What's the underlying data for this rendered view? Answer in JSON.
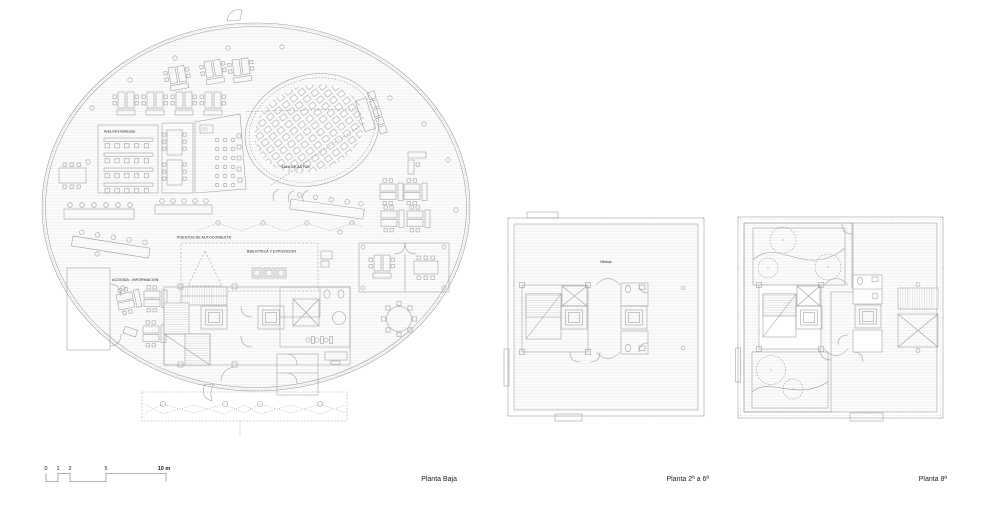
{
  "colors": {
    "line": "#9a9a9a",
    "wall": "#6e6e6e",
    "dark": "#454545",
    "text": "#222222",
    "green": "#e6ecd6",
    "green_light": "#f2f4e6",
    "green_line": "#b8c598",
    "beige": "#f7f0e9",
    "tick": "#5a5a5a"
  },
  "plans": {
    "baja": {
      "caption": "Planta Baja",
      "labels": {
        "aula": "Aula informatizada",
        "sala": "SALA DE ACTOS",
        "puestos": "PUESTOS DE AUTOCONSULTA",
        "biblioteca": "BIBLIOTECA Y EXPOSICION",
        "acogida": "ACOGIDA - INFORMACION"
      }
    },
    "middle": {
      "caption": "Planta 2ª a 6ª",
      "labels": {
        "oficinas": "Oficinas"
      }
    },
    "top": {
      "caption": "Planta 8ª"
    }
  },
  "scale_bar": {
    "t0": "0",
    "t1": "1",
    "t2": "2",
    "t5": "5",
    "t10": "10 m"
  }
}
